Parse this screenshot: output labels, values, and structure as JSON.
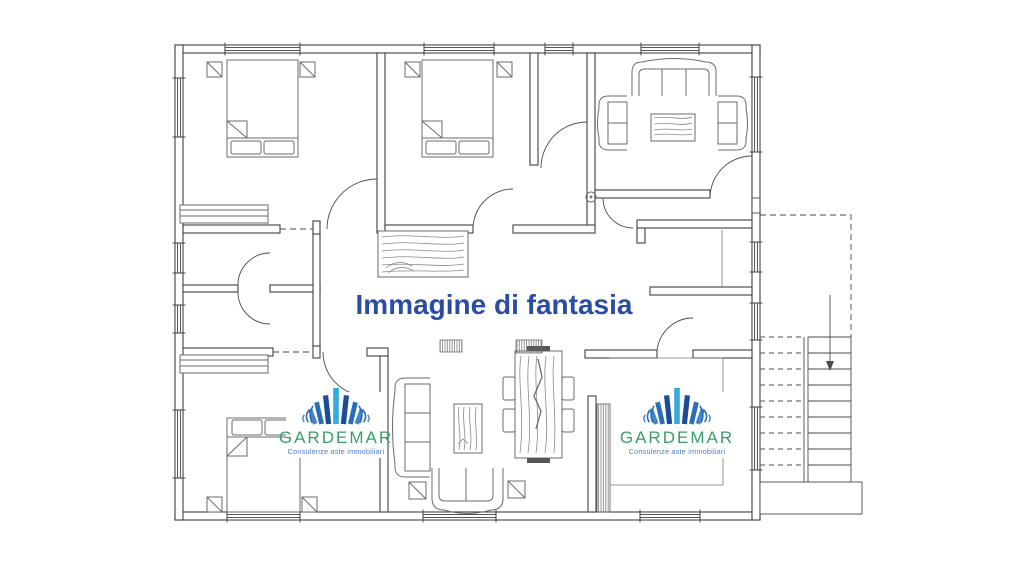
{
  "disclaimer": {
    "text": "Immagine di fantasia",
    "color": "#2a4da3"
  },
  "watermark": {
    "name": "GARDEMAR",
    "tagline": "Consulenze aste immobiliari",
    "name_color": "#379e68",
    "tagline_color": "#4b7fc8",
    "logo_colors": {
      "center": "#35aadd",
      "inner": "#1c4b97",
      "mid": "#2a6cb5",
      "outer": "#4587c9"
    }
  },
  "plan": {
    "wall_color": "#3f3f3f",
    "furniture_color": "#6b6b6b",
    "background": "#ffffff"
  }
}
